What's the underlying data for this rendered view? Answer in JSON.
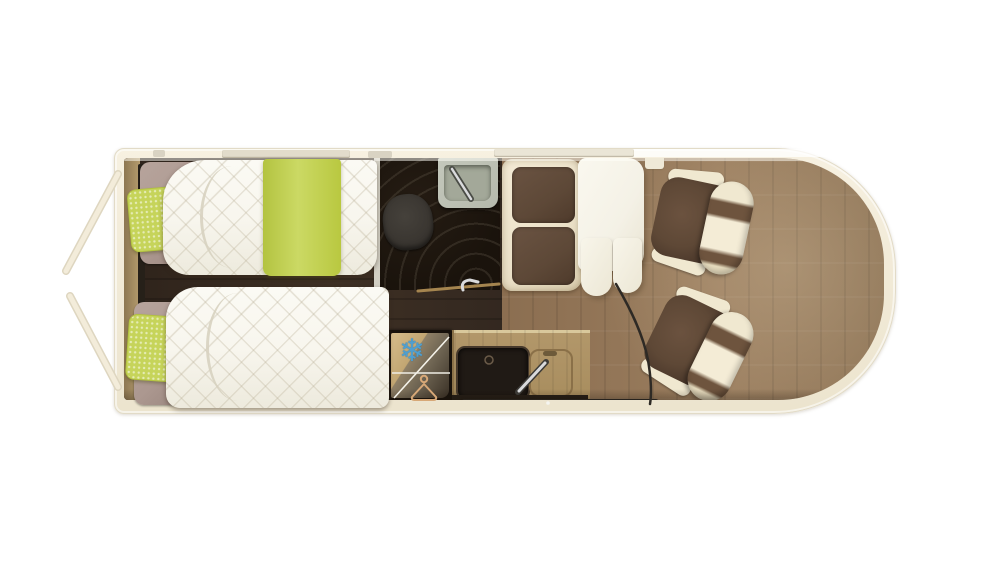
{
  "meta": {
    "description": "Top-down 3D rendered floor plan of a campervan motorhome interior",
    "view": "plan view",
    "background": "#ffffff"
  },
  "icons": {
    "snowflake_glyph": "❄",
    "snowflake_meaning": "fridge-freezer",
    "hanger_meaning": "wardrobe"
  },
  "colors": {
    "wall": "#f3ecda",
    "wall_edge": "#e2dbc7",
    "floor_living_a": "#74593f",
    "floor_living_b": "#9a7d5e",
    "floor_dark_a": "#2e231b",
    "floor_dark_b": "#3e3024",
    "platform_a": "#8d7752",
    "platform_b": "#b59c6e",
    "mattress": "#f8f6ee",
    "accent": "#c6d45a",
    "accent_deep": "#b3c340",
    "headboard": "#ac9890",
    "shower": "#1a130c",
    "toilet": "#38342f",
    "sink_unit": "#b5b9ac",
    "sink_basin": "#a3a899",
    "chrome": "#d9dadc",
    "bench": "#ece2ca",
    "cushion": "#5d4837",
    "table": "#f4f1e6",
    "chair_seat": "#5e4836",
    "chair_cream": "#f0e8d0",
    "chair_stripe": "#6e543e",
    "gold_a": "#d6bc8b",
    "gold_b": "#8f8066",
    "unit_dark": "#17110b",
    "snowflake": "#4f9fd0",
    "hanger": "#d7a877",
    "counter": "#b2976a",
    "counter_edge": "#241d16",
    "hob": "#201a15",
    "entry_bar": "#2b2824",
    "line_dark": "#2e2a25",
    "door_line": "#f3ecda"
  },
  "furniture": {
    "rear_bedroom": [
      "single-bed-top",
      "single-bed-bottom",
      "green-pillows",
      "green-runner"
    ],
    "washroom": [
      "shower",
      "toilet",
      "washbasin"
    ],
    "dinette": [
      "bench-seat",
      "table"
    ],
    "kitchen": [
      "fridge",
      "wardrobe",
      "hob",
      "sink"
    ],
    "cab": [
      "swivel-seat-front",
      "swivel-seat-rear"
    ],
    "exterior": [
      "open-rear-doors"
    ]
  }
}
